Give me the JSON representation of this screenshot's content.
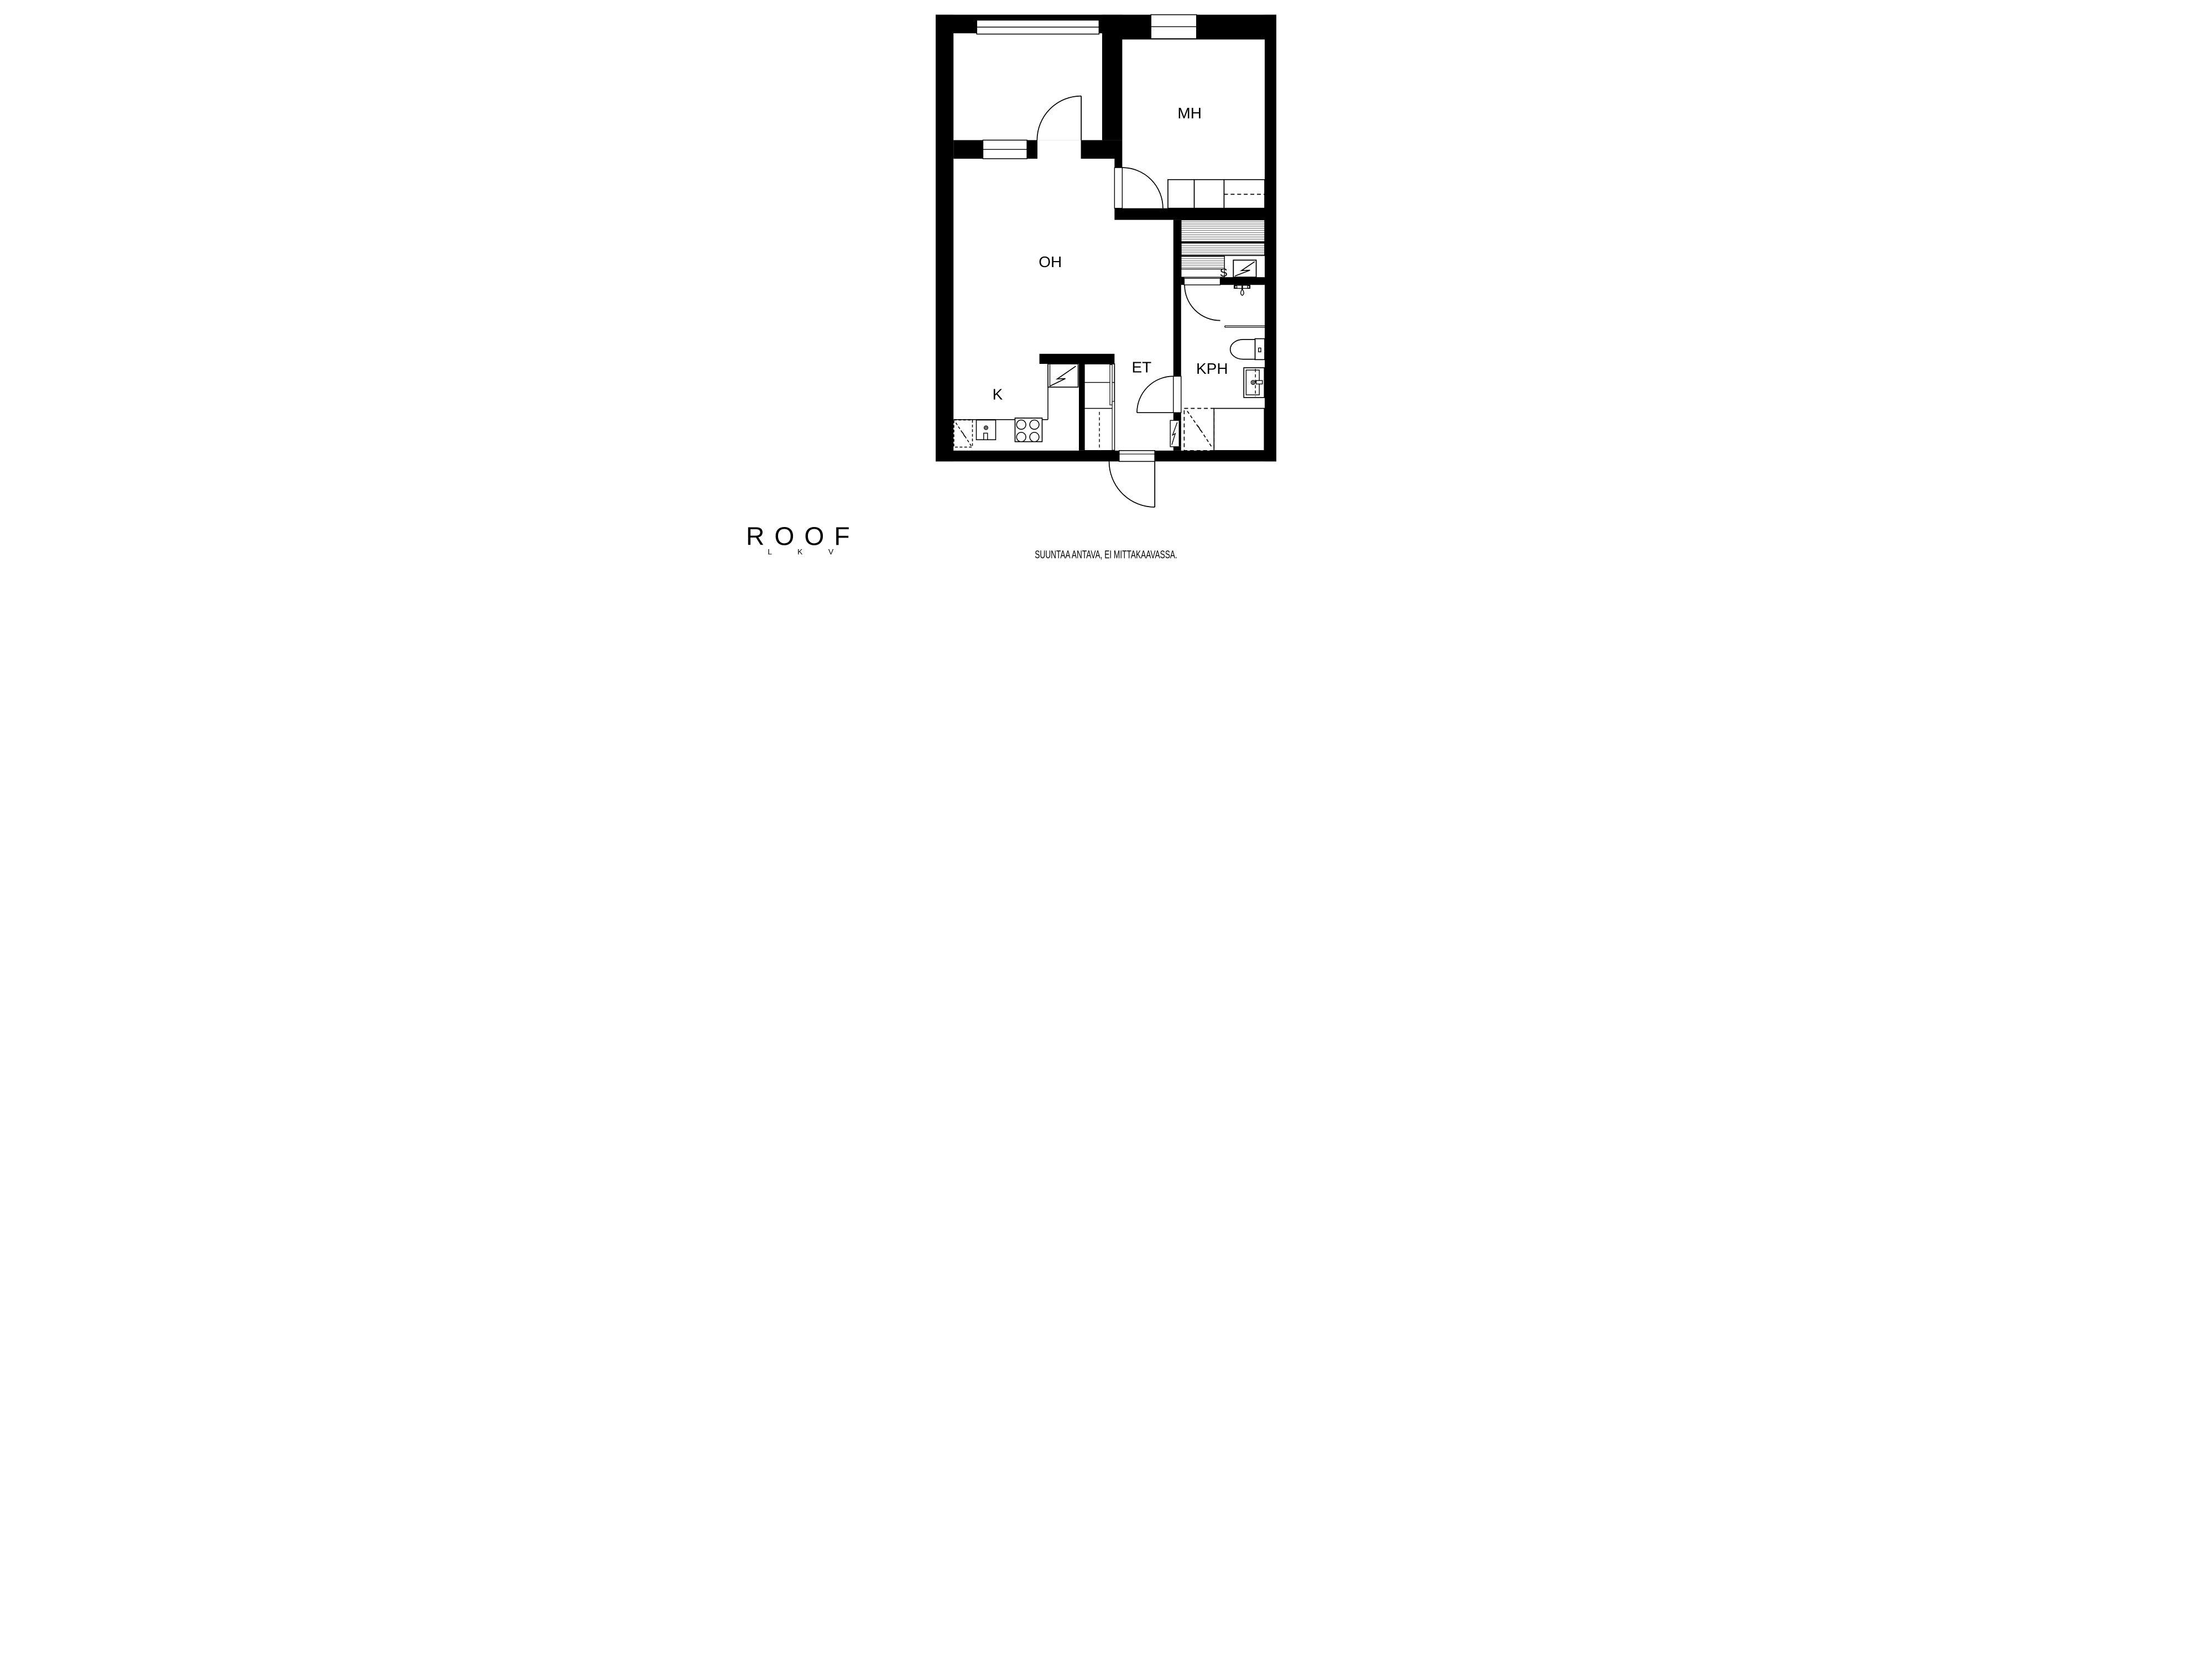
{
  "meta": {
    "document_type": "apartment floor plan"
  },
  "colors": {
    "background": "#ffffff",
    "walls": "#000000",
    "lines": "#000000",
    "bench_stripe": "#444444"
  },
  "floor_plan": {
    "rooms": [
      {
        "id": "mh",
        "label": "MH"
      },
      {
        "id": "oh",
        "label": "OH"
      },
      {
        "id": "k",
        "label": "K"
      },
      {
        "id": "et",
        "label": "ET"
      },
      {
        "id": "kph",
        "label": "KPH"
      },
      {
        "id": "s",
        "label": "S"
      }
    ],
    "fixtures": [
      "sauna-heater-icon",
      "sauna-benches",
      "shower-icon",
      "shower-rail",
      "toilet-icon",
      "washbasin-icon",
      "washing-machine-reservation",
      "electrical-panel-icon",
      "refrigerator-icon",
      "stove-icon",
      "kitchen-sink-icon",
      "appliance-reservation",
      "wardrobe",
      "closet-units",
      "windows",
      "doors"
    ]
  },
  "footer": {
    "logo": {
      "brand": "ROOF",
      "sub": "L K V"
    },
    "disclaimer": "SUUNTAA ANTAVA, EI MITTAKAAVASSA."
  }
}
